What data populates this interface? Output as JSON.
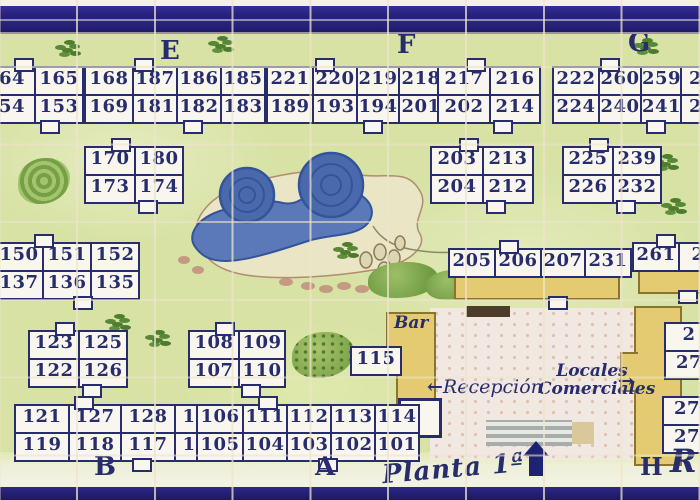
{
  "labels": {
    "floor": "Planta 1ª",
    "bar": "Bar",
    "reception": "Recepción",
    "reception_arrow": "←",
    "locales_line1": "Locales",
    "locales_line2": "Comerciales",
    "locales_arrow": "→",
    "sections": {
      "E": "E",
      "F": "F",
      "G": "G",
      "B": "B",
      "A": "A",
      "H": "H",
      "R": "R"
    }
  },
  "colors": {
    "navy": "#272c6d",
    "border_band": "#2a2386",
    "grass": "#d7e2a4",
    "cell_bg": "#f8f6ee",
    "pool_blue": "#5b79b8",
    "pool_dark": "#33549b",
    "sand": "#eae6c5",
    "building_yellow": "#e4ca70",
    "pavement_pink": "#f1e8e2"
  },
  "blocks": [
    {
      "x": -12,
      "y": 68,
      "cols": [
        44,
        46
      ],
      "rows": [
        [
          "64",
          "165"
        ],
        [
          "54",
          "153"
        ]
      ]
    },
    {
      "x": 84,
      "y": 68,
      "cols": [
        46,
        42,
        42,
        42
      ],
      "rows": [
        [
          "168",
          "187",
          "186",
          "185"
        ],
        [
          "169",
          "181",
          "182",
          "183"
        ]
      ]
    },
    {
      "x": 266,
      "y": 68,
      "cols": [
        44,
        42,
        40,
        42
      ],
      "rows": [
        [
          "221",
          "220",
          "219",
          "218"
        ],
        [
          "189",
          "193",
          "194",
          "201"
        ]
      ]
    },
    {
      "x": 437,
      "y": 68,
      "cols": [
        50,
        48
      ],
      "rows": [
        [
          "217",
          "216"
        ],
        [
          "202",
          "214"
        ]
      ]
    },
    {
      "x": 552,
      "y": 68,
      "cols": [
        44,
        40,
        38,
        40
      ],
      "rows": [
        [
          "222",
          "260",
          "259",
          "25"
        ],
        [
          "224",
          "240",
          "241",
          "24"
        ]
      ]
    },
    {
      "x": 84,
      "y": 148,
      "cols": [
        48,
        46
      ],
      "rows": [
        [
          "170",
          "180"
        ],
        [
          "173",
          "174"
        ]
      ]
    },
    {
      "x": 430,
      "y": 148,
      "cols": [
        50,
        48
      ],
      "rows": [
        [
          "203",
          "213"
        ],
        [
          "204",
          "212"
        ]
      ]
    },
    {
      "x": 562,
      "y": 148,
      "cols": [
        48,
        46
      ],
      "rows": [
        [
          "225",
          "239"
        ],
        [
          "226",
          "232"
        ]
      ]
    },
    {
      "x": -6,
      "y": 244,
      "cols": [
        46,
        46,
        46
      ],
      "rows": [
        [
          "150",
          "151",
          "152"
        ],
        [
          "137",
          "136",
          "135"
        ]
      ]
    },
    {
      "x": 448,
      "y": 250,
      "cols": [
        44,
        44,
        42,
        44
      ],
      "rows": [
        [
          "205",
          "206",
          "207",
          "231"
        ]
      ],
      "band": true
    },
    {
      "x": 632,
      "y": 244,
      "cols": [
        44,
        36
      ],
      "rows": [
        [
          "261",
          "2"
        ]
      ],
      "band": true
    },
    {
      "x": 28,
      "y": 332,
      "cols": [
        48,
        46
      ],
      "rows": [
        [
          "123",
          "125"
        ],
        [
          "122",
          "126"
        ]
      ]
    },
    {
      "x": 188,
      "y": 332,
      "cols": [
        48,
        44
      ],
      "rows": [
        [
          "108",
          "109"
        ],
        [
          "107",
          "110"
        ]
      ]
    },
    {
      "x": 350,
      "y": 346,
      "cols": [
        48
      ],
      "rows": [
        [
          "115"
        ]
      ],
      "tabs": false
    },
    {
      "x": 664,
      "y": 322,
      "cols": [
        46
      ],
      "rows": [
        [
          "2"
        ],
        [
          "27"
        ]
      ],
      "tabs": false
    },
    {
      "x": 662,
      "y": 396,
      "cols": [
        46
      ],
      "rows": [
        [
          "27"
        ],
        [
          "27"
        ]
      ],
      "tabs": false
    },
    {
      "x": 14,
      "y": 406,
      "cols": [
        52,
        50,
        52,
        52
      ],
      "rows": [
        [
          "121",
          "127",
          "128",
          "129"
        ],
        [
          "119",
          "118",
          "117",
          "116"
        ]
      ]
    },
    {
      "x": 196,
      "y": 406,
      "cols": [
        44,
        42,
        42,
        42,
        42
      ],
      "rows": [
        [
          "106",
          "111",
          "112",
          "113",
          "114"
        ],
        [
          "105",
          "104",
          "103",
          "102",
          "101"
        ]
      ]
    }
  ]
}
